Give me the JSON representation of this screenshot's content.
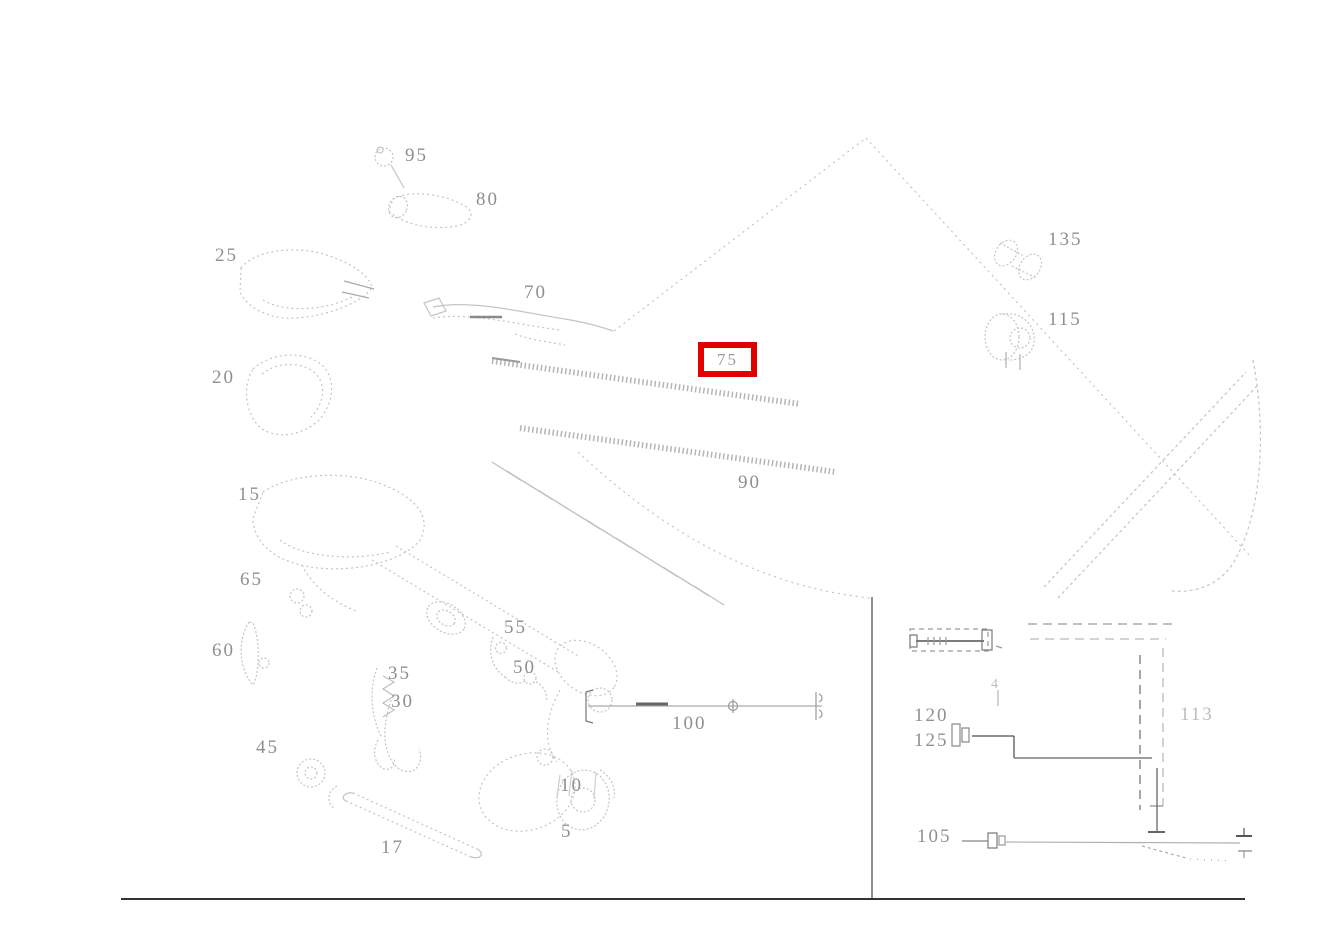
{
  "page": {
    "background": "#ffffff"
  },
  "diagram": {
    "type": "exploded-parts-diagram",
    "description": "Faint line-art exploded parts diagram (exterior mirror assembly) with gray part numbers; one part number highlighted with a red box; small wiring inset at lower right.",
    "line_color": "#c4c4c4",
    "label_color": "#8f8f8f",
    "divider_color": "#333333",
    "highlight": {
      "label": "75",
      "color": "#e10000",
      "x": 698,
      "y": 342,
      "w": 59,
      "h": 35
    },
    "labels": [
      {
        "text": "95",
        "x": 405,
        "y": 146
      },
      {
        "text": "80",
        "x": 476,
        "y": 190
      },
      {
        "text": "25",
        "x": 215,
        "y": 246
      },
      {
        "text": "70",
        "x": 524,
        "y": 283
      },
      {
        "text": "20",
        "x": 212,
        "y": 368
      },
      {
        "text": "90",
        "x": 738,
        "y": 473
      },
      {
        "text": "15",
        "x": 238,
        "y": 485
      },
      {
        "text": "65",
        "x": 240,
        "y": 570
      },
      {
        "text": "60",
        "x": 212,
        "y": 641
      },
      {
        "text": "55",
        "x": 504,
        "y": 618
      },
      {
        "text": "50",
        "x": 513,
        "y": 658
      },
      {
        "text": "35",
        "x": 388,
        "y": 664
      },
      {
        "text": "30",
        "x": 391,
        "y": 692
      },
      {
        "text": "100",
        "x": 672,
        "y": 714
      },
      {
        "text": "45",
        "x": 256,
        "y": 738
      },
      {
        "text": "10",
        "x": 560,
        "y": 776
      },
      {
        "text": "5",
        "x": 561,
        "y": 822
      },
      {
        "text": "17",
        "x": 381,
        "y": 838
      },
      {
        "text": "135",
        "x": 1048,
        "y": 230
      },
      {
        "text": "115",
        "x": 1048,
        "y": 310
      },
      {
        "text": "120",
        "x": 914,
        "y": 706
      },
      {
        "text": "125",
        "x": 914,
        "y": 731
      },
      {
        "text": "113",
        "x": 1180,
        "y": 705,
        "dim": true
      },
      {
        "text": "105",
        "x": 917,
        "y": 827
      },
      {
        "text": "4",
        "x": 991,
        "y": 678,
        "dim": true,
        "small": true
      }
    ]
  }
}
